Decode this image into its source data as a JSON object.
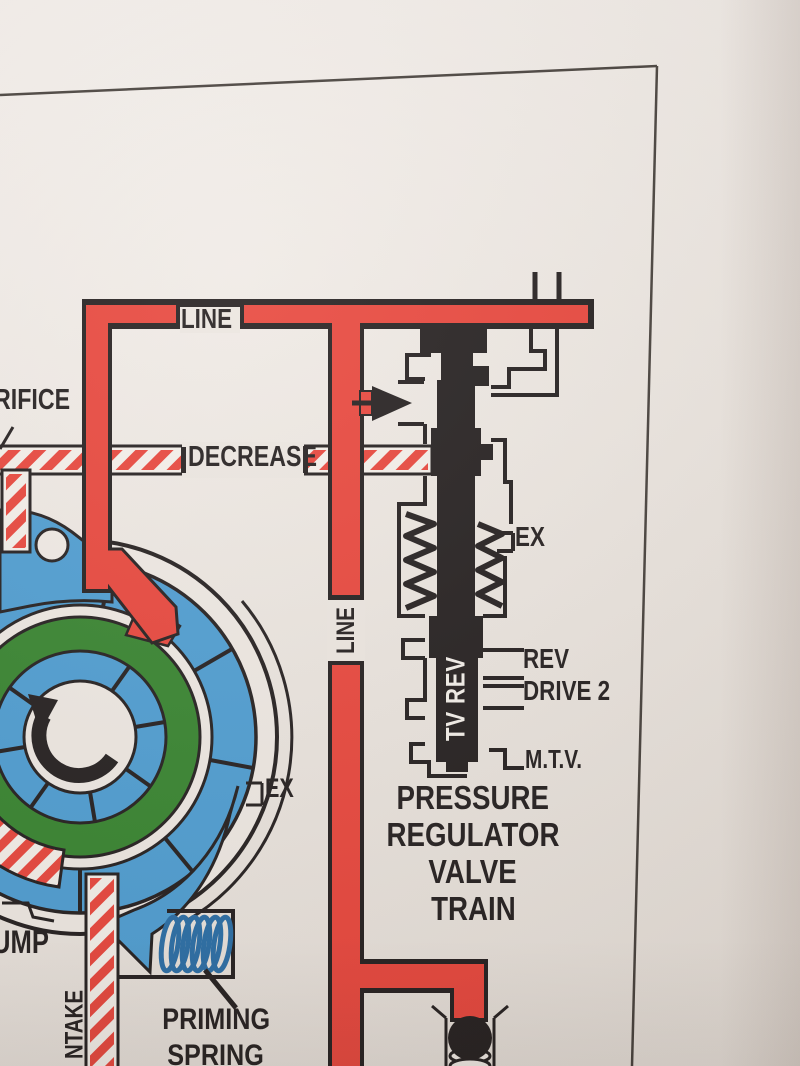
{
  "page": {
    "description": "Transmission hydraulic circuit diagram page (photo)",
    "border_color": "#47413c",
    "paper_color": "#ece6e0"
  },
  "colors": {
    "line_pressure_red": "#e8463c",
    "intake_blue": "#4e9dd1",
    "rotor_green": "#37842f",
    "linework_black": "#241f1f",
    "spring_blue": "#2a6da5",
    "spool_text_white": "#f3efe9"
  },
  "labels": {
    "line_top": "LINE",
    "line_vertical": "LINE",
    "orifice_partial": "RIFICE",
    "decrease": "DECREASE",
    "ex_valve": "EX",
    "rev_port": "REV",
    "drive_2_port": "DRIVE 2",
    "mtv_port": "M.T.V.",
    "spool_vertical": "TV REV",
    "pump_ex": "EX",
    "pump_partial": "UMP",
    "intake_partial": "NTAKE",
    "priming_line1": "PRIMING",
    "priming_line2": "SPRING",
    "valve_title": {
      "l1": "PRESSURE",
      "l2": "REGULATOR",
      "l3": "VALVE",
      "l4": "TRAIN"
    }
  }
}
